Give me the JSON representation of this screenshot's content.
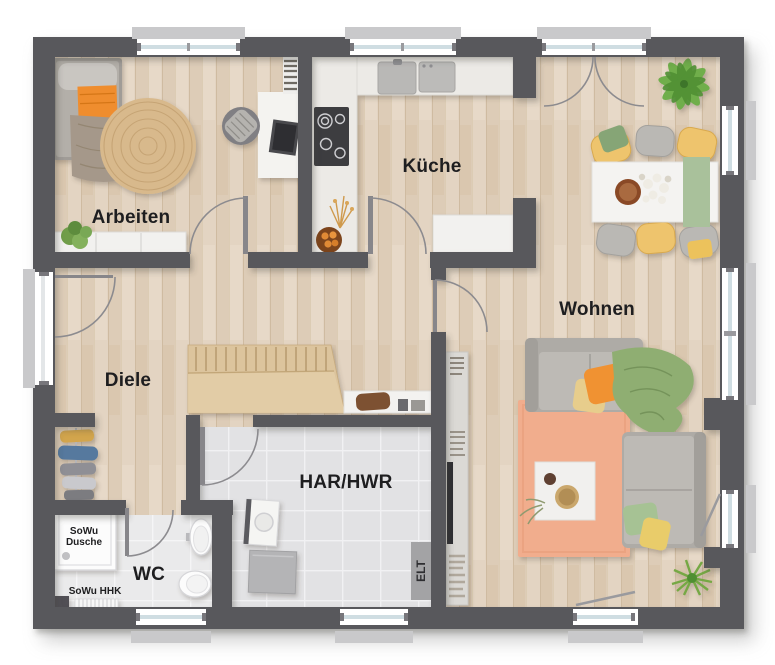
{
  "labels": {
    "arbeiten": "Arbeiten",
    "kueche": "Küche",
    "wohnen": "Wohnen",
    "diele": "Diele",
    "har_hwr": "HAR/HWR",
    "wc": "WC",
    "shower_line1": "SoWu",
    "shower_line2": "Dusche",
    "heater": "SoWu HHK",
    "elt": "ELT"
  },
  "colors": {
    "wall": "#59585c",
    "floor-wood": "#e3d4c2",
    "floor-tile": "#e2e2e4",
    "floor-tile-wc": "#eaeaec",
    "window-glass": "#cfdde2",
    "window-sill": "#c9c9cb",
    "accent-orange": "#ef8d2e",
    "rug-peach": "#f1ad8d",
    "rug-jute": "#d8b98c",
    "chair-yellow": "#eec46d",
    "sofa-gray": "#aeaba6",
    "plant-green": "#6fae4c",
    "sage-green": "#a9c19b",
    "stairs-wood": "#dcc49d",
    "label-text": "#1e1e20"
  }
}
